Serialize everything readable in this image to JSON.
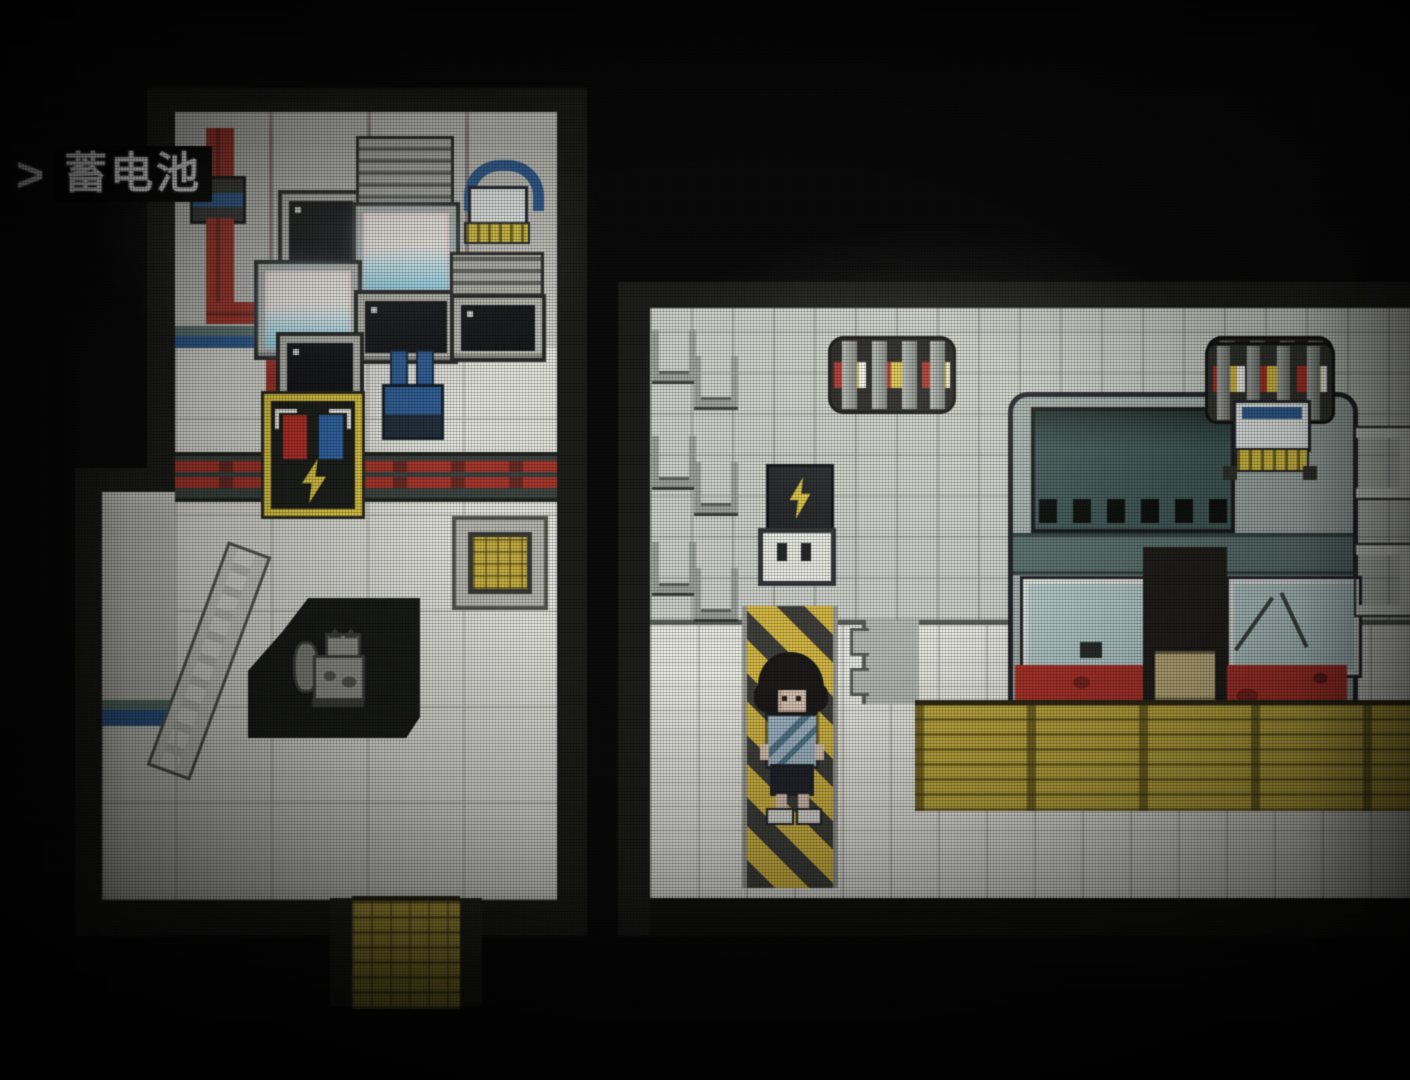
{
  "hud": {
    "prompt_marker": ">",
    "objective_label": "蓄电池"
  },
  "colors": {
    "bg": "#0a0a0a",
    "hud_text": "#ededed",
    "hud_box": "#050505",
    "wall_light": "#c6c6c0",
    "wall_right": "#cacdc6",
    "floor_left": "#deded8",
    "floor_right": "#e6e6e0",
    "cable_red": "#a8352a",
    "accent_blue": "#2f5f96",
    "battery_yellow": "#d8c23e",
    "terminal_red": "#b83028",
    "hazard_yellow": "#d2b53e",
    "hazard_dark": "#3f3f3b",
    "grate_yellow": "#c2ab3c",
    "machine_red": "#b2332a",
    "glass_teal": "#b3cbca"
  },
  "scene": {
    "left_room": {
      "objects": [
        "power-cables",
        "crt-monitors",
        "control-consoles",
        "robot-device",
        "blue-connector",
        "battery-unit",
        "cable-duct",
        "floor-hatch",
        "ladder",
        "floor-pit",
        "cat",
        "exit-grate"
      ]
    },
    "right_room": {
      "objects": [
        "wall-rung-ladders",
        "wall-vents",
        "lightning-outlet",
        "generator-machine",
        "robot-device",
        "hazard-floor-strip",
        "player-character",
        "yellow-floor-grate",
        "wall-brackets"
      ]
    }
  }
}
